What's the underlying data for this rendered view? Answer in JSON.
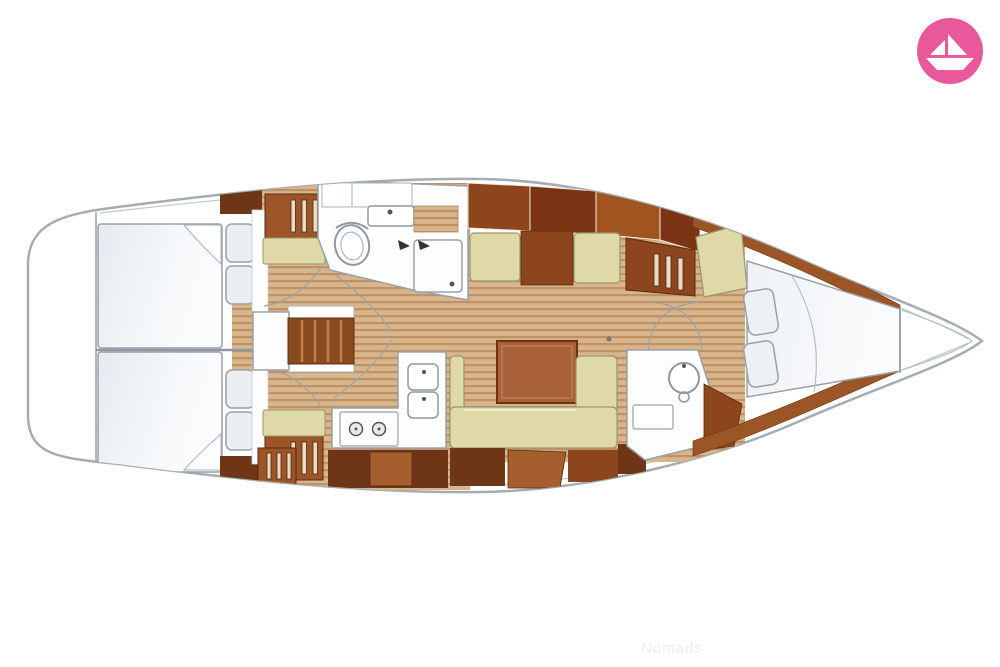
{
  "watermark": {
    "text": "Nomads",
    "color": "#ededed"
  },
  "logo": {
    "background_color": "#e8589b",
    "icon": "paper-boat-icon"
  },
  "floor_plan": {
    "type": "sailing-yacht-interior-top-view",
    "orientation": "bow-right-stern-left",
    "palette": {
      "hull_outline": "#a4adb3",
      "inner_deck_line": "#c5cbd0",
      "wood_dark": "#6f3517",
      "wood_red_brown": "#7a3414",
      "wood_medium": "#8c451c",
      "wood_orange": "#a9613a",
      "wood_trim": "#9c5526",
      "floor_base": "#d7b68c",
      "floor_stripe": "#c29067",
      "cushion_cream": "#ded9a6",
      "mattress_white": "#f5f7f9",
      "fixture_white": "#fdfdfe"
    },
    "areas": [
      {
        "id": "aft-cabin-upper",
        "feature": "double-berth-with-two-pillows"
      },
      {
        "id": "aft-cabin-lower",
        "feature": "double-berth-with-two-pillows"
      },
      {
        "id": "companionway",
        "feature": "entry-stairs"
      },
      {
        "id": "main-head",
        "feature": "toilet-sink-shower"
      },
      {
        "id": "galley",
        "feature": "double-sink-two-burner-stove"
      },
      {
        "id": "saloon",
        "feature": "u-shaped-settee-with-table"
      },
      {
        "id": "second-head",
        "feature": "washbasin-vanity"
      },
      {
        "id": "forward-cabin",
        "feature": "v-berth-with-two-pillows"
      },
      {
        "id": "bow",
        "feature": "anchor-locker"
      }
    ]
  }
}
